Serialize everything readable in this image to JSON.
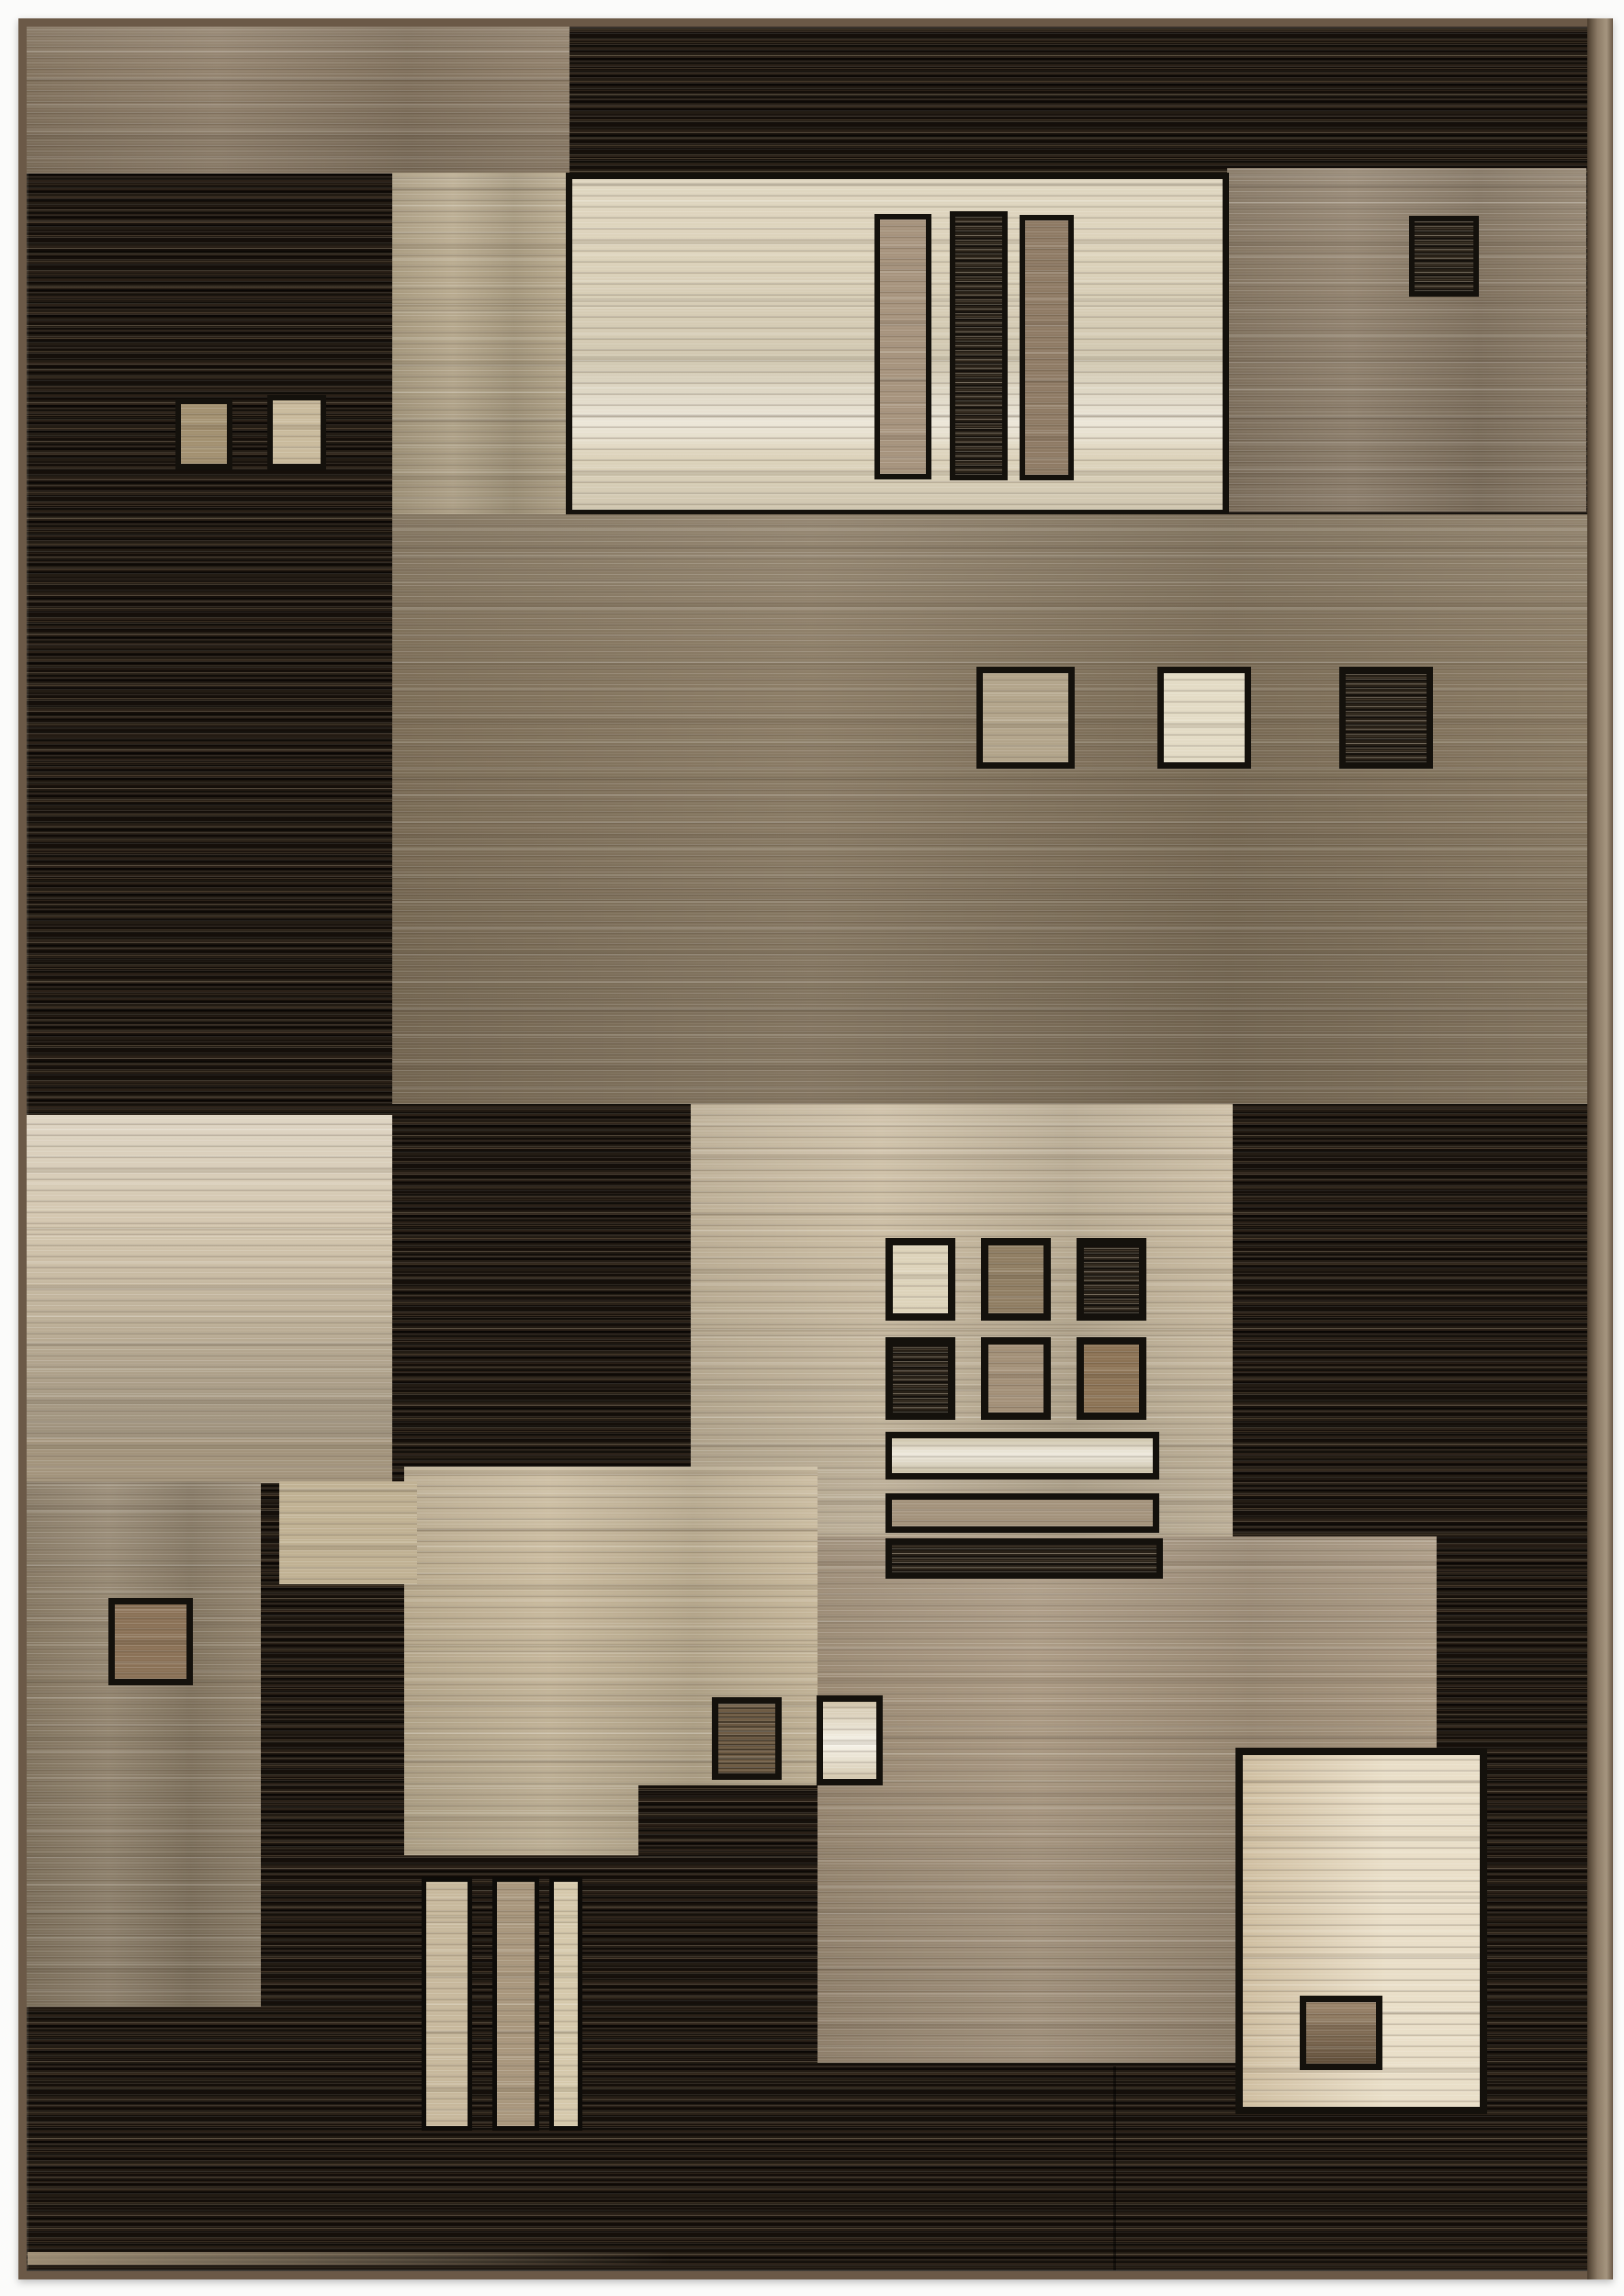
{
  "scene": {
    "type": "photograph",
    "subject": "modern geometric area rug, portrait orientation, photographed flat on a white background",
    "style": "contemporary color-block pattern with horizontal striated pile texture",
    "visible_text": "none"
  },
  "palette": {
    "page_background": "#fbfbfa",
    "rug_binding": "#6b5947",
    "rug_side_binding": "#8d7c67",
    "dark_field": "#1e1811",
    "dark_field_streak": "#6b5a43",
    "top_left_taupe": "#8c7b65",
    "top_right_tan": "#8d7d68",
    "beige_column": "#b5a689",
    "cream_panel": "#dcd2ba",
    "panel_bar_tan": "#a6937d",
    "panel_bar_dark": "#272017",
    "panel_bar_brown": "#8e7a64",
    "middle_band_taupe": "#85755d",
    "band_square_tan": "#b2a48a",
    "band_square_cream": "#e3dbc5",
    "band_square_dark": "#272017",
    "left_small_square_tan": "#a29070",
    "left_small_square_cream": "#c9ba9c",
    "left_cream_block": "#cfc1a8",
    "grid_block_beige": "#c9ba9f",
    "grid_square_cream": "#ddd3ba",
    "grid_square_brown": "#8f7d62",
    "grid_square_taupe": "#a28f77",
    "grid_square_chestnut": "#8b7254",
    "hbar_cream": "#d9cfb4",
    "hbar_tan": "#a3927b",
    "mid_left_beige": "#c6b698",
    "drab_block": "#8e7f68",
    "drab_square_brown": "#8a7156",
    "lower_taupe_block": "#a5937b",
    "small_dark_square": "#6f5c44",
    "small_cream_square": "#eae1c9",
    "bottom_right_cream_panel": "#e2d3b5",
    "bottom_right_square_brown": "#8a7052",
    "vbar_beige": "#c7b89c",
    "vbar_tan": "#a8967c",
    "vbar_cream": "#d5c8ab",
    "block_outline": "#14110c"
  },
  "composition": {
    "blocks": [
      {
        "name": "top-left-taupe-block",
        "fill": "#8c7b65"
      },
      {
        "name": "top-dark-band",
        "fill": "#1e1811"
      },
      {
        "name": "top-right-tan-block",
        "fill": "#8d7d68",
        "children": [
          "small dark square"
        ]
      },
      {
        "name": "left-dark-column",
        "fill": "#1e1811",
        "children": [
          "tan square",
          "cream square"
        ]
      },
      {
        "name": "beige-column",
        "fill": "#b5a689"
      },
      {
        "name": "cream-panel",
        "fill": "#dcd2ba",
        "children": [
          "three vertical bars: tan, dark, brown"
        ]
      },
      {
        "name": "middle-taupe-band",
        "fill": "#85755d",
        "children": [
          "tan square",
          "cream square",
          "dark square"
        ]
      },
      {
        "name": "left-cream-block",
        "fill": "#cfc1a8"
      },
      {
        "name": "center-grid-block",
        "fill": "#c9ba9f",
        "children": [
          "2x3 grid of outlined squares",
          "three horizontal bars"
        ]
      },
      {
        "name": "mid-left-beige-block",
        "fill": "#c6b698"
      },
      {
        "name": "drab-block",
        "fill": "#8e7f68",
        "children": [
          "brown square"
        ]
      },
      {
        "name": "lower-taupe-block",
        "fill": "#a5937b"
      },
      {
        "name": "small-dark-square",
        "fill": "#6f5c44"
      },
      {
        "name": "small-cream-square",
        "fill": "#eae1c9"
      },
      {
        "name": "bottom-right-cream-panel",
        "fill": "#e2d3b5",
        "children": [
          "brown square"
        ]
      },
      {
        "name": "bottom-left-vertical-bars",
        "fill": "#c7b89c / #a8967c / #d5c8ab"
      },
      {
        "name": "bottom-dark-field",
        "fill": "#1e1811"
      }
    ]
  }
}
